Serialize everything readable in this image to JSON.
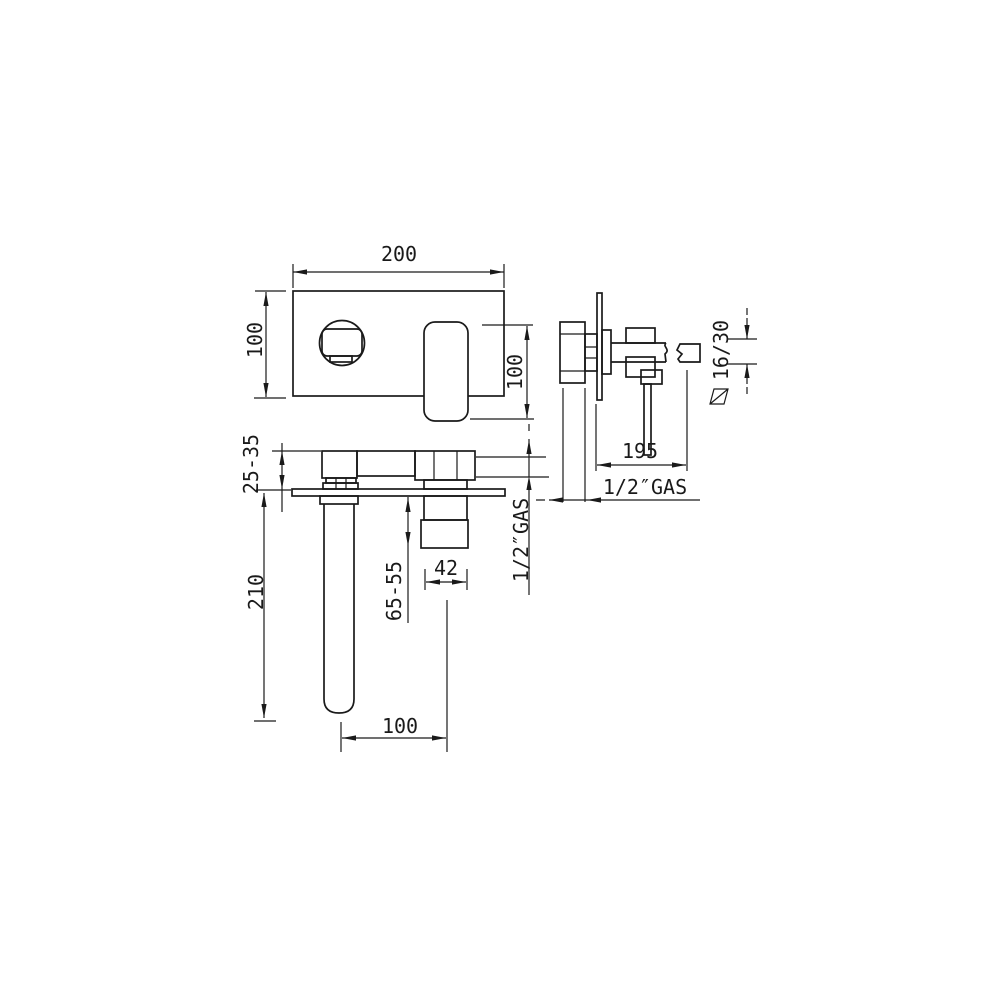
{
  "drawing": {
    "background": "#ffffff",
    "line_color": "#1a1a1a",
    "front_view": {
      "width_dim": "200",
      "height_dim": "100",
      "spout_length_dim": "100"
    },
    "side_view": {
      "spout_projection_dim": "195",
      "inlet_thread_label": "1/2″GAS",
      "spout_section_dim": "16/30"
    },
    "top_view": {
      "wall_clearance_dim": "25-35",
      "spout_drop_dim": "210",
      "body_depth_dim": "65-55",
      "cartridge_width_dim": "42",
      "spout_offset_dim": "100",
      "outlet_thread_label": "1/2″GAS"
    }
  }
}
